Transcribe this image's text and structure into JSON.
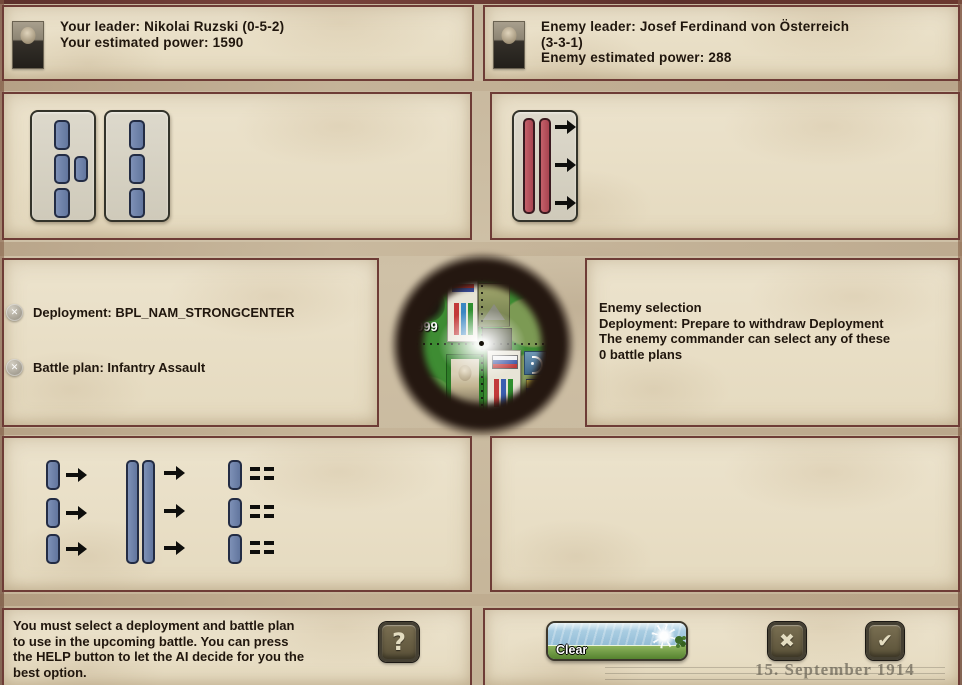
{
  "colors": {
    "parchment": "#e9dfc7",
    "panel_border": "#6e3c36",
    "bar_blue": "#6d80a8",
    "bar_red": "#b44f5b",
    "card_bg": "#d8d4c6",
    "button_face": "#6f6449",
    "button_glyph": "#e4ddc1",
    "map_green": "#3e8c33"
  },
  "header": {
    "player": {
      "portrait_icon": "player-leader-portrait",
      "text": "Your leader: Nikolai Ruzski (0-5-2)\nYour estimated power: 1590"
    },
    "enemy": {
      "portrait_icon": "enemy-leader-portrait",
      "text": "Enemy leader: Josef Ferdinand von Österreich\n(3-3-1)\nEnemy estimated power: 288"
    }
  },
  "deployment_options": {
    "player": [
      {
        "icon": "formation-strong-center-icon"
      },
      {
        "icon": "formation-single-line-icon"
      }
    ],
    "enemy": [
      {
        "icon": "formation-two-line-advance-icon"
      }
    ]
  },
  "selection": {
    "player": {
      "remove_icon": "✕",
      "deployment": "Deployment: BPL_NAM_STRONGCENTER",
      "battle_plan": "Battle plan: Infantry Assault"
    },
    "enemy": {
      "text": "Enemy selection\nDeployment: Prepare to withdraw Deployment\nThe enemy commander can select any of these\n0 battle plans"
    }
  },
  "scope": {
    "strength_badge": "999",
    "icons": [
      "unit-counter-card",
      "terrain-tile",
      "commander-portrait",
      "russian-flag-counter",
      "crescent-status-icon"
    ]
  },
  "battle_plan_options": [
    {
      "icon": "plan-three-column-advance-icon"
    },
    {
      "icon": "plan-mass-frontal-assault-icon"
    },
    {
      "icon": "plan-hold-line-icon"
    }
  ],
  "footer": {
    "help_text": "You must select a deployment and battle plan\nto use in the upcoming battle. You can press\nthe HELP button to let the AI decide for you the\nbest option.",
    "help_button_glyph": "?",
    "clear_button_label": "Clear",
    "cancel_button_glyph": "✖",
    "confirm_button_glyph": "✔",
    "date_watermark": "15. September 1914"
  }
}
